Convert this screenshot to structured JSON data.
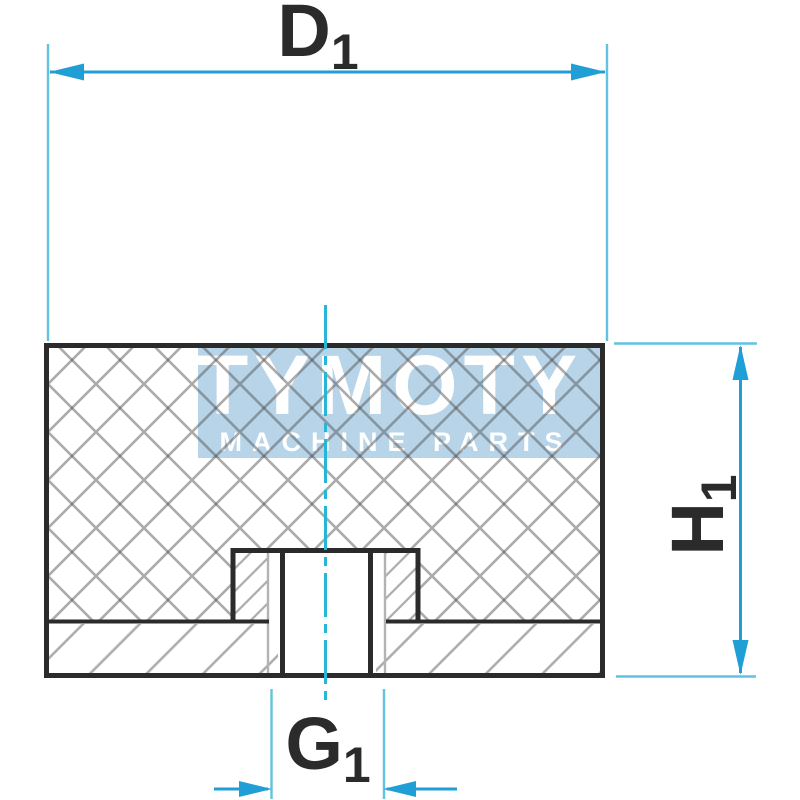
{
  "drawing": {
    "type_note": "rubber buffer cross-section drawing"
  },
  "watermark": {
    "brand": "TYMOTY",
    "tagline": "MACHINE PARTS"
  },
  "dimensions": {
    "d1": {
      "letter": "D",
      "subscript": "1"
    },
    "h1": {
      "letter": "H",
      "subscript": "1"
    },
    "g1": {
      "letter": "G",
      "subscript": "1"
    }
  },
  "colors": {
    "dimension_line": "#1f9fd6",
    "extension_line": "#62c2e2",
    "centerline": "#27b5d8",
    "outline": "#2b2b2b",
    "thread_line": "#b3b3b3",
    "label_color": "#2b2b2b",
    "watermark_bg": "#b8d4e8",
    "watermark_text": "#ffffff"
  }
}
